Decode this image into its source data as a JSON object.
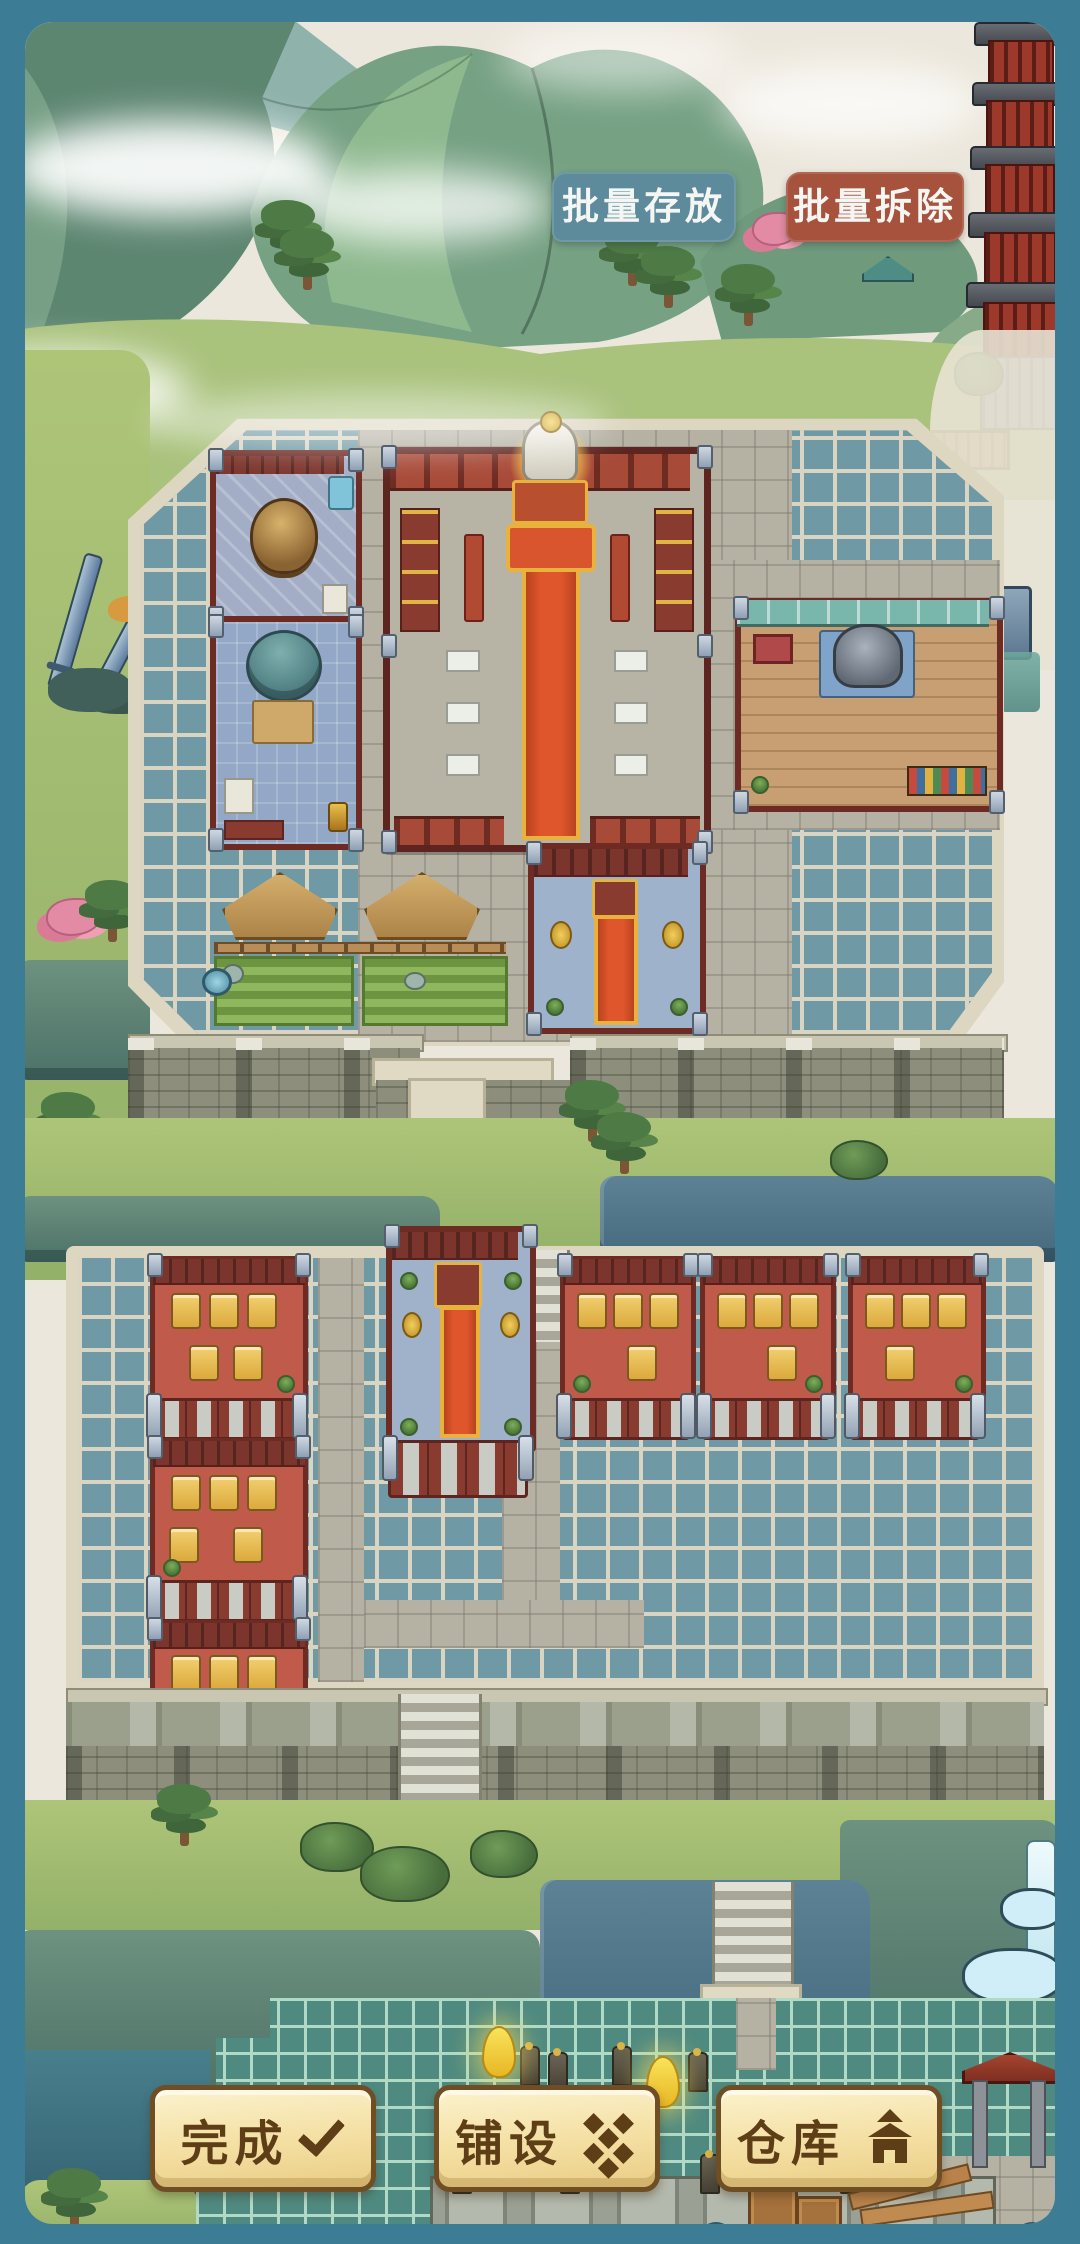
{
  "ui": {
    "top_buttons": [
      {
        "id": "batch-store",
        "label": "批量存放"
      },
      {
        "id": "batch-demolish",
        "label": "批量拆除"
      }
    ],
    "bottom_buttons": [
      {
        "id": "finish",
        "label": "完成",
        "icon": "check-icon"
      },
      {
        "id": "pave",
        "label": "铺设",
        "icon": "floor-tiles-icon"
      },
      {
        "id": "warehouse",
        "label": "仓库",
        "icon": "warehouse-icon"
      }
    ]
  },
  "palette": {
    "frame_teal": "#3c7d95",
    "paper_sky": "#ece7dc",
    "mountain_green": "#76a183",
    "grid_tile_teal": "#6f99a4",
    "grid_grout_cream": "#d9d5c2",
    "bottom_grid_tile": "#4f8a80",
    "plaza_stone": "#b5b2a4",
    "wall_stone": "#8d8f7c",
    "grass_green": "#a3bd74",
    "cliff_slate": "#53788c",
    "building_wall_red": "#a34636",
    "room_floor_red": "#c05a4b",
    "carpet_orange": "#e0562c",
    "table_gold": "#e7bf4a",
    "store_button_teal": "#5d8b9c",
    "demolish_button_red": "#a6523c",
    "panel_cream": "#f5e4ad",
    "panel_border_brown": "#6f4e26",
    "panel_text_brown": "#5d3e16",
    "glow_gold": "#ffe066"
  }
}
